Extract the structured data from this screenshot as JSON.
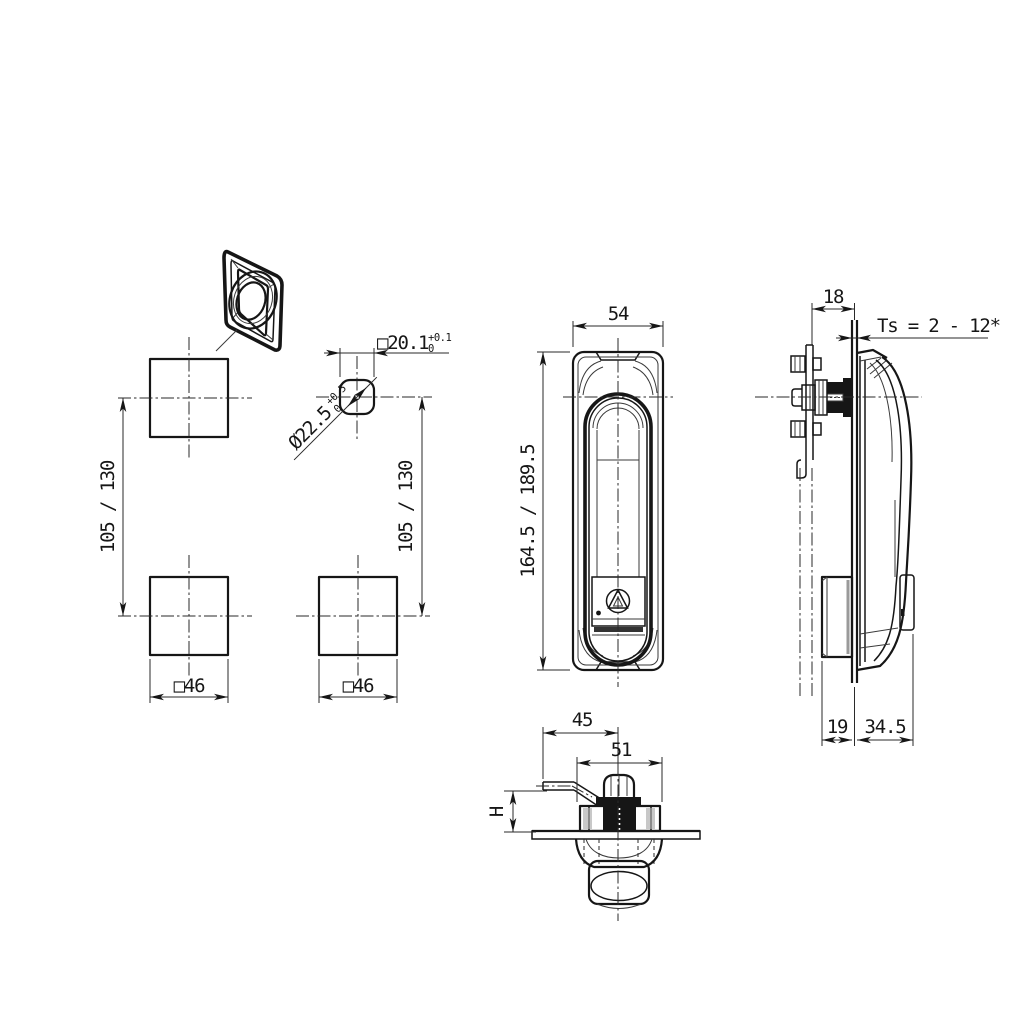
{
  "drawing": {
    "kind": "technical-drawing-swing-handle-lock",
    "background": "#ffffff",
    "line_color": "#161616"
  },
  "dimensions": {
    "cutout_square": {
      "label": "□20.1",
      "tol_upper": "+0.1",
      "tol_lower": "0"
    },
    "cutout_diameter": {
      "label": "Ø22.5",
      "tol_upper": "+0.5",
      "tol_lower": "0"
    },
    "spacing_left": {
      "label": "105 / 130"
    },
    "spacing_right": {
      "label": "105 / 130"
    },
    "square_left": {
      "label": "□46"
    },
    "square_right": {
      "label": "□46"
    },
    "front_width": {
      "label": "54"
    },
    "front_height": {
      "label": "164.5 / 189.5"
    },
    "rear_depth": {
      "label": "18"
    },
    "panel_thickness": {
      "label": "Ts = 2 - 12*"
    },
    "rear_clearance": {
      "label": "19"
    },
    "front_protrusion": {
      "label": "34.5"
    },
    "cam_tip_offset": {
      "label": "45"
    },
    "body_width": {
      "label": "51"
    },
    "grip_height": {
      "label": "H"
    }
  }
}
